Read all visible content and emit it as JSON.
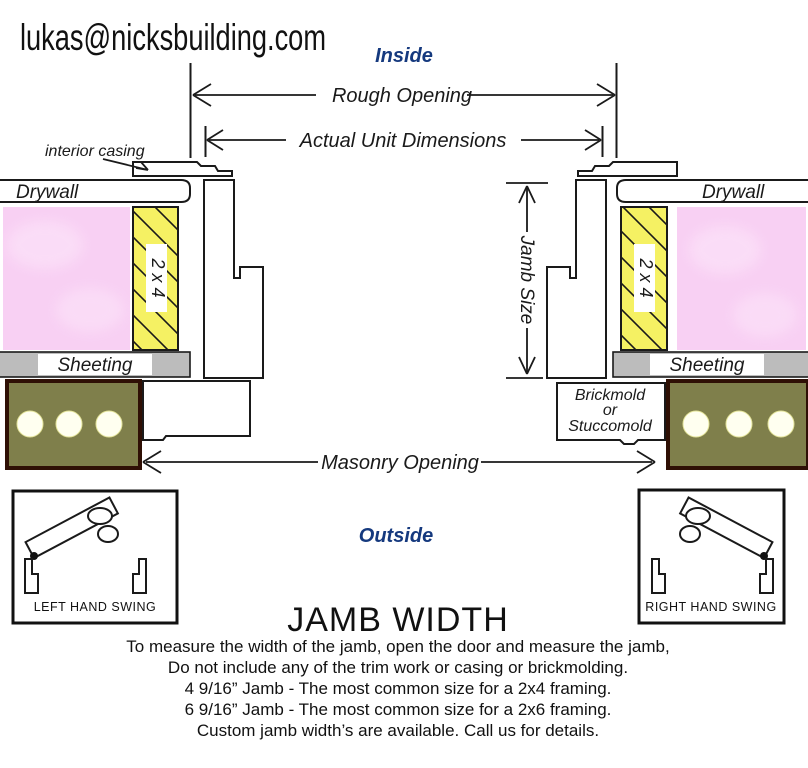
{
  "colors": {
    "line": "#1a1a1a",
    "blue": "#15397e",
    "stud_yellow": "#f5f163",
    "insulation_pink": "#f8d0f3",
    "insulation_light": "#fde9fb",
    "sheeting_gray": "#bcbcbc",
    "masonry_olive": "#7f7f4b",
    "masonry_border": "#2f1005",
    "masonry_hole": "#fffff0"
  },
  "header": {
    "email": "lukas@nicksbuilding.com",
    "inside": "Inside",
    "outside": "Outside"
  },
  "dimensions": {
    "rough_opening": "Rough Opening",
    "actual_unit": "Actual Unit Dimensions",
    "jamb_size": "Jamb Size",
    "masonry_opening": "Masonry Opening"
  },
  "wall": {
    "interior_casing": "interior casing",
    "drywall_left": "Drywall",
    "drywall_right": "Drywall",
    "stud_left": "2 x 4",
    "stud_right": "2 x 4",
    "sheeting_left": "Sheeting",
    "sheeting_right": "Sheeting",
    "brickmold": {
      "line1": "Brickmold",
      "line2": "or",
      "line3": "Stuccomold"
    }
  },
  "swings": {
    "left": "LEFT HAND SWING",
    "right": "RIGHT HAND SWING"
  },
  "footer": {
    "heading": "JAMB WIDTH",
    "lines": [
      "To measure the width of the jamb, open the door and measure the jamb,",
      "Do not include any of the trim work or casing or brickmolding.",
      "4 9/16” Jamb - The most common size for a 2x4 framing.",
      "6 9/16” Jamb - The most common size for a 2x6 framing.",
      "Custom jamb width’s are available. Call us for details."
    ]
  }
}
